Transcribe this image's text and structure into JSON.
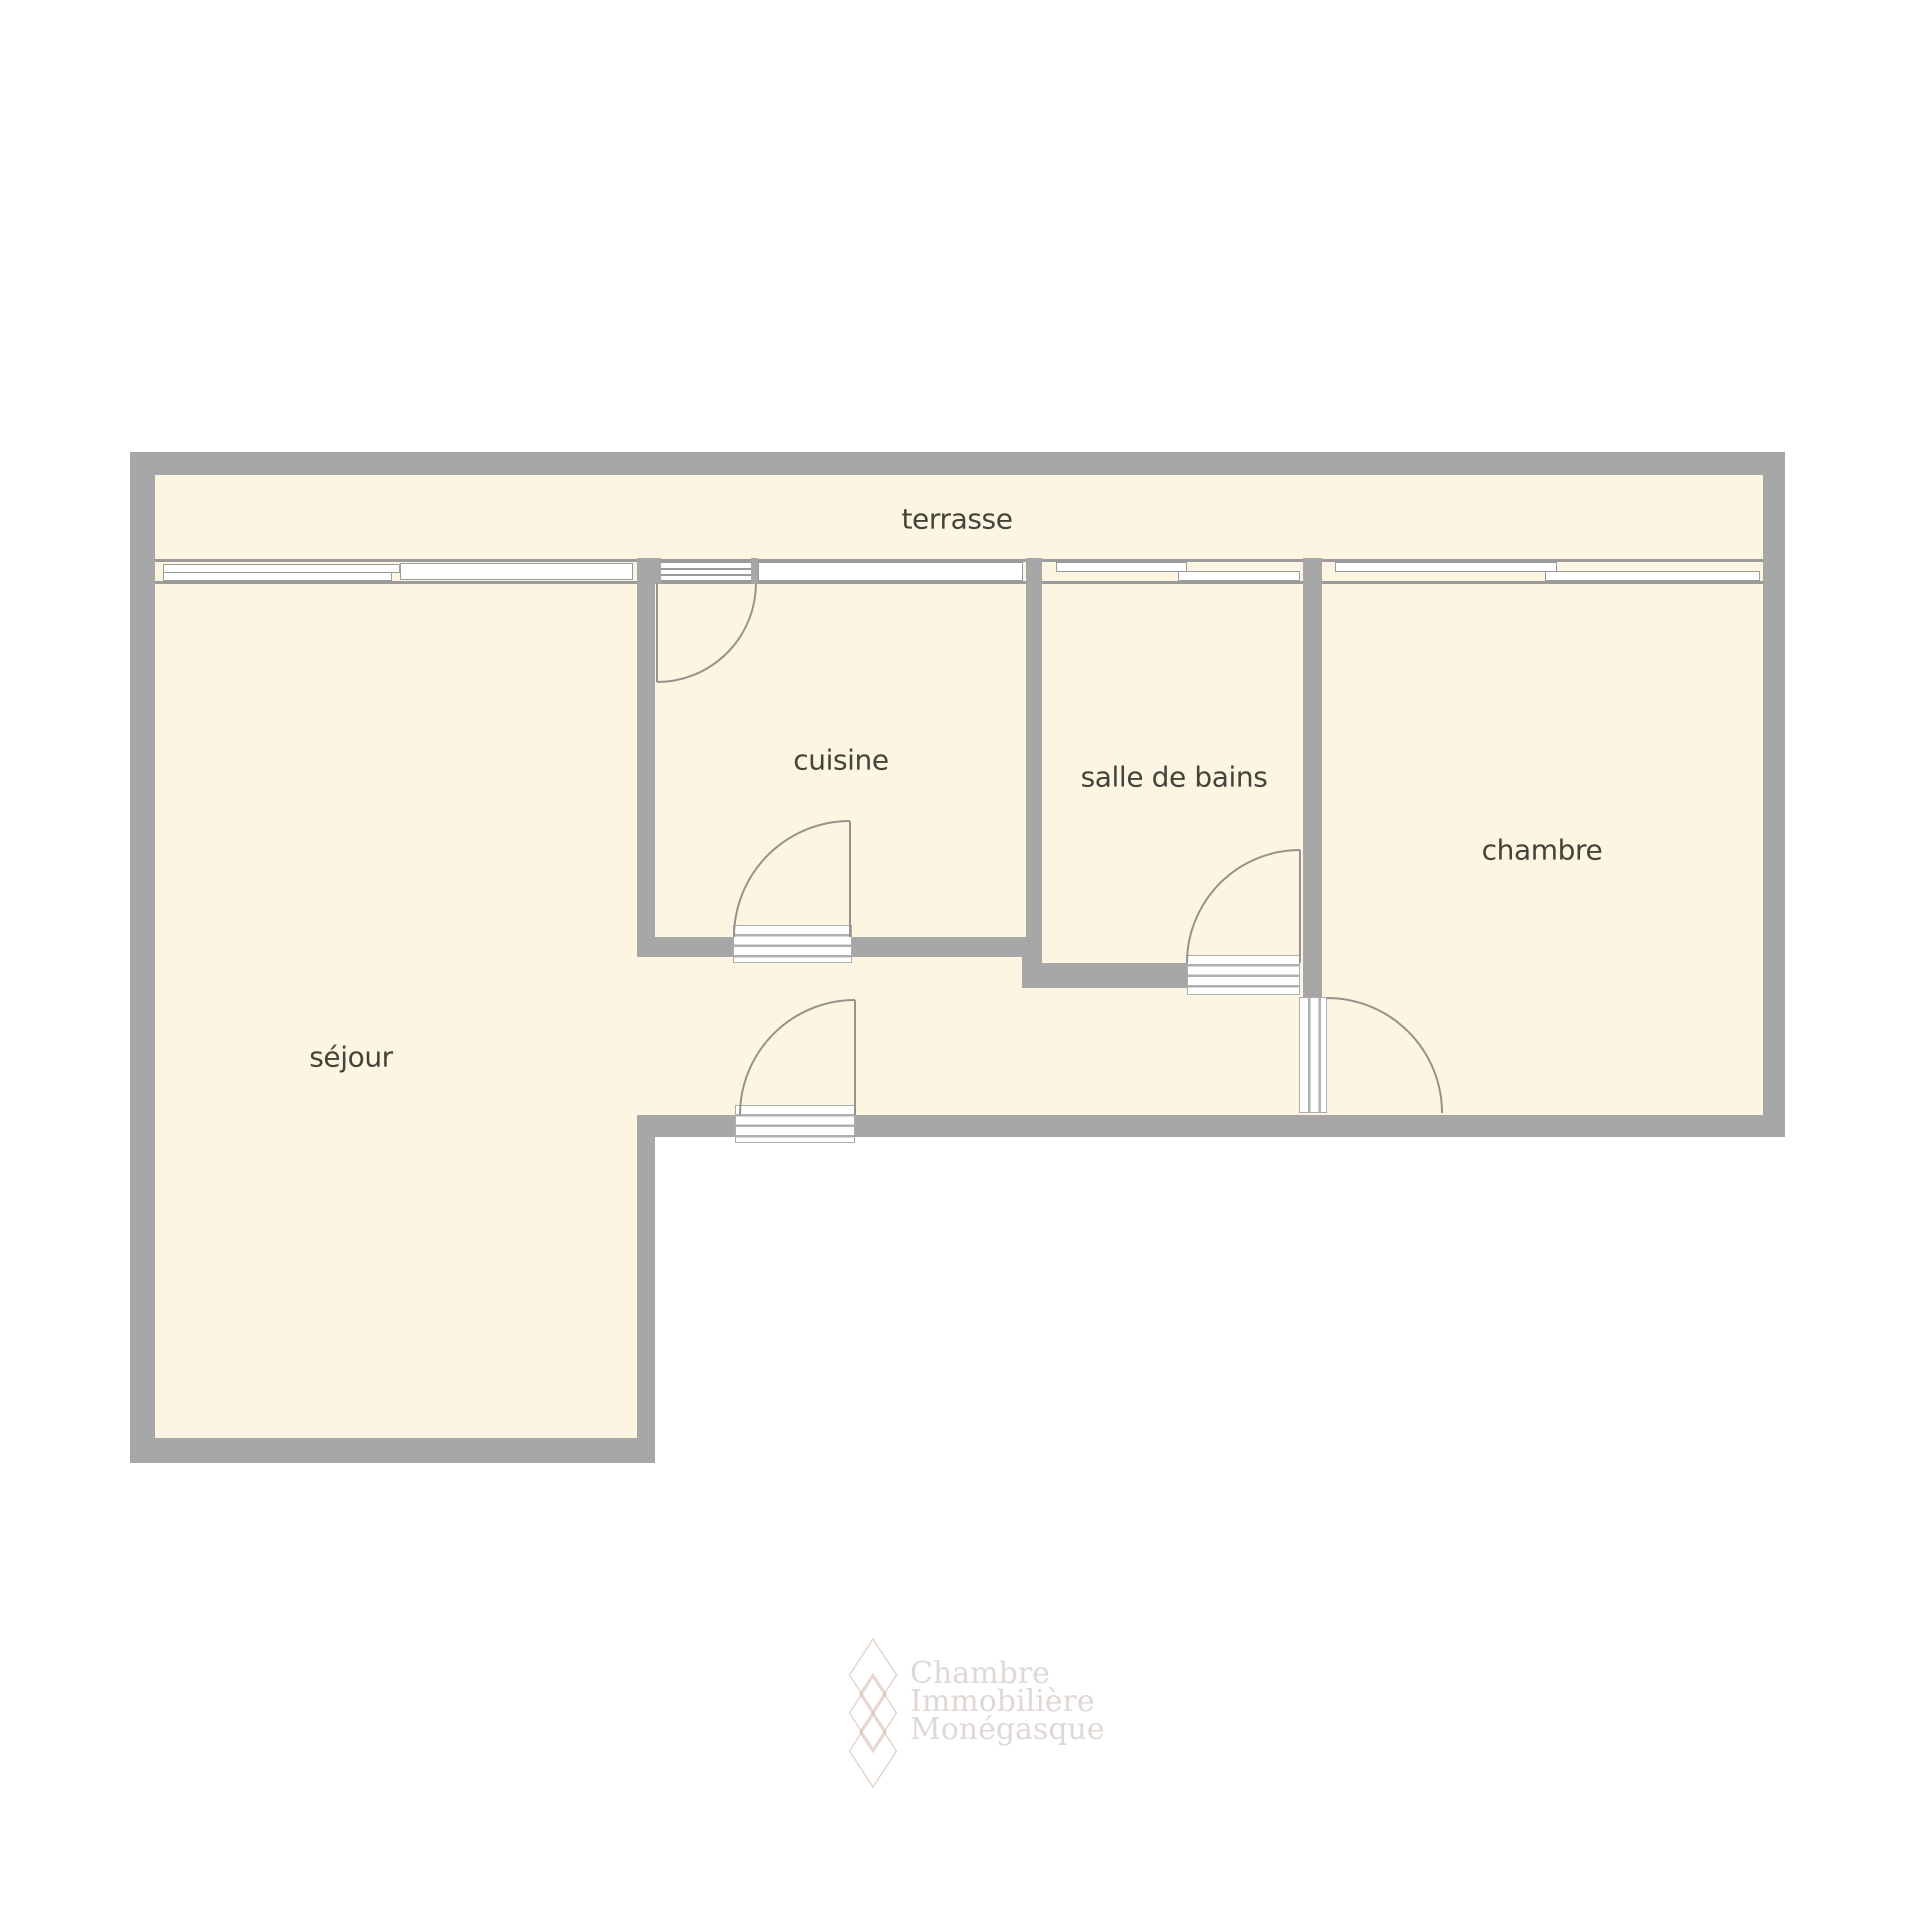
{
  "page": {
    "background": "#ffffff"
  },
  "colors": {
    "floor_fill": "#fbf5e2",
    "wall_fill": "#a7a7a7",
    "window_line": "#9b9b9b",
    "threshold_line": "#b0b0b0",
    "door_arc": "#95938b",
    "label_text": "#45443a",
    "watermark_text": "rgba(176,158,148,0.40)",
    "watermark_logo": "rgba(206,170,158,0.50)"
  },
  "rooms": [
    {
      "id": "terrasse",
      "label": "terrasse",
      "cx": 957,
      "cy": 519
    },
    {
      "id": "cuisine",
      "label": "cuisine",
      "cx": 841,
      "cy": 760
    },
    {
      "id": "salle-de-bains",
      "label": "salle de bains",
      "cx": 1174,
      "cy": 777
    },
    {
      "id": "chambre",
      "label": "chambre",
      "cx": 1542,
      "cy": 850
    },
    {
      "id": "sejour",
      "label": "séjour",
      "cx": 351,
      "cy": 1057
    }
  ],
  "watermark": {
    "line1": "Chambre",
    "line2": "Immobilière",
    "line3": "Monégasque",
    "text_x": 910,
    "text_y": 1660
  },
  "geometry": {
    "floor_polygon": "155px 475px, 1763px 475px, 1763px 1115px, 655px 1115px, 655px 1438px, 155px 1438px",
    "walls": [
      {
        "id": "outer-top",
        "x": 130,
        "y": 452,
        "w": 1655,
        "h": 23
      },
      {
        "id": "outer-left",
        "x": 130,
        "y": 452,
        "w": 25,
        "h": 1011
      },
      {
        "id": "outer-right",
        "x": 1763,
        "y": 452,
        "w": 22,
        "h": 685
      },
      {
        "id": "sejour-bottom",
        "x": 130,
        "y": 1438,
        "w": 525,
        "h": 25
      },
      {
        "id": "sejour-right-lower",
        "x": 637,
        "y": 1115,
        "w": 18,
        "h": 348
      },
      {
        "id": "hall-bottom-west",
        "x": 637,
        "y": 1115,
        "w": 98,
        "h": 22
      },
      {
        "id": "hall-bottom-east",
        "x": 855,
        "y": 1115,
        "w": 930,
        "h": 22
      },
      {
        "id": "sejour-cuisine",
        "x": 637,
        "y": 558,
        "w": 18,
        "h": 399
      },
      {
        "id": "cuisine-bottom-west",
        "x": 637,
        "y": 937,
        "w": 96,
        "h": 20
      },
      {
        "id": "cuisine-bottom-east",
        "x": 852,
        "y": 937,
        "w": 174,
        "h": 20
      },
      {
        "id": "junction-block",
        "x": 1022,
        "y": 937,
        "w": 20,
        "h": 51
      },
      {
        "id": "sdb-bottom",
        "x": 1042,
        "y": 963,
        "w": 145,
        "h": 25
      },
      {
        "id": "cuisine-sdb",
        "x": 1026,
        "y": 558,
        "w": 16,
        "h": 405
      },
      {
        "id": "sdb-chambre",
        "x": 1303,
        "y": 558,
        "w": 19,
        "h": 439
      }
    ],
    "window_line": {
      "y_top": 559,
      "y_bottom": 581,
      "line_h": 3
    },
    "window_spans": [
      {
        "id": "terrace-edge-sejour",
        "x1": 155,
        "x2": 637
      },
      {
        "id": "terrace-edge-cuisine",
        "x1": 655,
        "x2": 1026
      },
      {
        "id": "terrace-edge-sdb",
        "x1": 1042,
        "x2": 1303
      },
      {
        "id": "terrace-edge-chambre",
        "x1": 1322,
        "x2": 1763
      }
    ],
    "window_panels": [
      {
        "id": "sejour-pane-1",
        "x": 163,
        "y": 564,
        "w": 237,
        "h": 9
      },
      {
        "id": "sejour-pane-2",
        "x": 163,
        "y": 572,
        "w": 229,
        "h": 9
      },
      {
        "id": "sejour-pane-3",
        "x": 400,
        "y": 563,
        "w": 233,
        "h": 17
      },
      {
        "id": "cuisine-pane",
        "x": 758,
        "y": 562,
        "w": 265,
        "h": 19
      },
      {
        "id": "sdb-pane-1",
        "x": 1056,
        "y": 562,
        "w": 131,
        "h": 10
      },
      {
        "id": "sdb-pane-2",
        "x": 1178,
        "y": 571,
        "w": 122,
        "h": 10
      },
      {
        "id": "chambre-pane-1",
        "x": 1335,
        "y": 562,
        "w": 222,
        "h": 10
      },
      {
        "id": "chambre-pane-2",
        "x": 1545,
        "y": 571,
        "w": 215,
        "h": 10
      }
    ],
    "porte_fenetre": {
      "x": 658,
      "y": 562,
      "w": 97,
      "h": 19,
      "lines_y": [
        568,
        574
      ],
      "jambs": [
        {
          "x": 654,
          "y": 558,
          "w": 7,
          "h": 26
        },
        {
          "x": 751,
          "y": 558,
          "w": 7,
          "h": 26
        }
      ]
    },
    "thresholds": [
      {
        "id": "door-cuisine",
        "x": 733,
        "y": 925,
        "w": 119,
        "h": 38,
        "dir": "h"
      },
      {
        "id": "door-entrance",
        "x": 735,
        "y": 1105,
        "w": 120,
        "h": 38,
        "dir": "h"
      },
      {
        "id": "door-sdb",
        "x": 1187,
        "y": 955,
        "w": 113,
        "h": 40,
        "dir": "h"
      },
      {
        "id": "door-chambre",
        "x": 1299,
        "y": 997,
        "w": 28,
        "h": 116,
        "dir": "v"
      }
    ],
    "door_arcs": [
      {
        "id": "swing-terrace-cuisine",
        "d": "M 756 583 A 99 99 0 0 1 657 682"
      },
      {
        "id": "swing-cuisine",
        "d": "M 734 937 A 116 116 0 0 1 850 821"
      },
      {
        "id": "swing-entrance",
        "d": "M 740 1115 A 115 115 0 0 1 855 1000"
      },
      {
        "id": "swing-sdb",
        "d": "M 1187 963 A 113 113 0 0 1 1300 850"
      },
      {
        "id": "swing-chambre",
        "d": "M 1327 998 A 115 115 0 0 1 1442 1113"
      }
    ],
    "door_leaves": [
      {
        "id": "leaf-terrace-cuisine",
        "x1": 657,
        "y1": 583,
        "x2": 657,
        "y2": 682
      },
      {
        "id": "leaf-cuisine",
        "x1": 850,
        "y1": 821,
        "x2": 850,
        "y2": 937
      },
      {
        "id": "leaf-entrance",
        "x1": 855,
        "y1": 1000,
        "x2": 855,
        "y2": 1115
      },
      {
        "id": "leaf-sdb",
        "x1": 1300,
        "y1": 850,
        "x2": 1300,
        "y2": 963
      }
    ],
    "logo_diamonds": [
      {
        "cx": 873,
        "cy": 1675,
        "w": 47,
        "h": 72
      },
      {
        "cx": 873,
        "cy": 1713,
        "w": 47,
        "h": 72
      },
      {
        "cx": 873,
        "cy": 1751,
        "w": 47,
        "h": 72
      },
      {
        "cx": 873,
        "cy": 1694,
        "w": 26,
        "h": 40
      },
      {
        "cx": 873,
        "cy": 1732,
        "w": 26,
        "h": 40
      }
    ]
  }
}
